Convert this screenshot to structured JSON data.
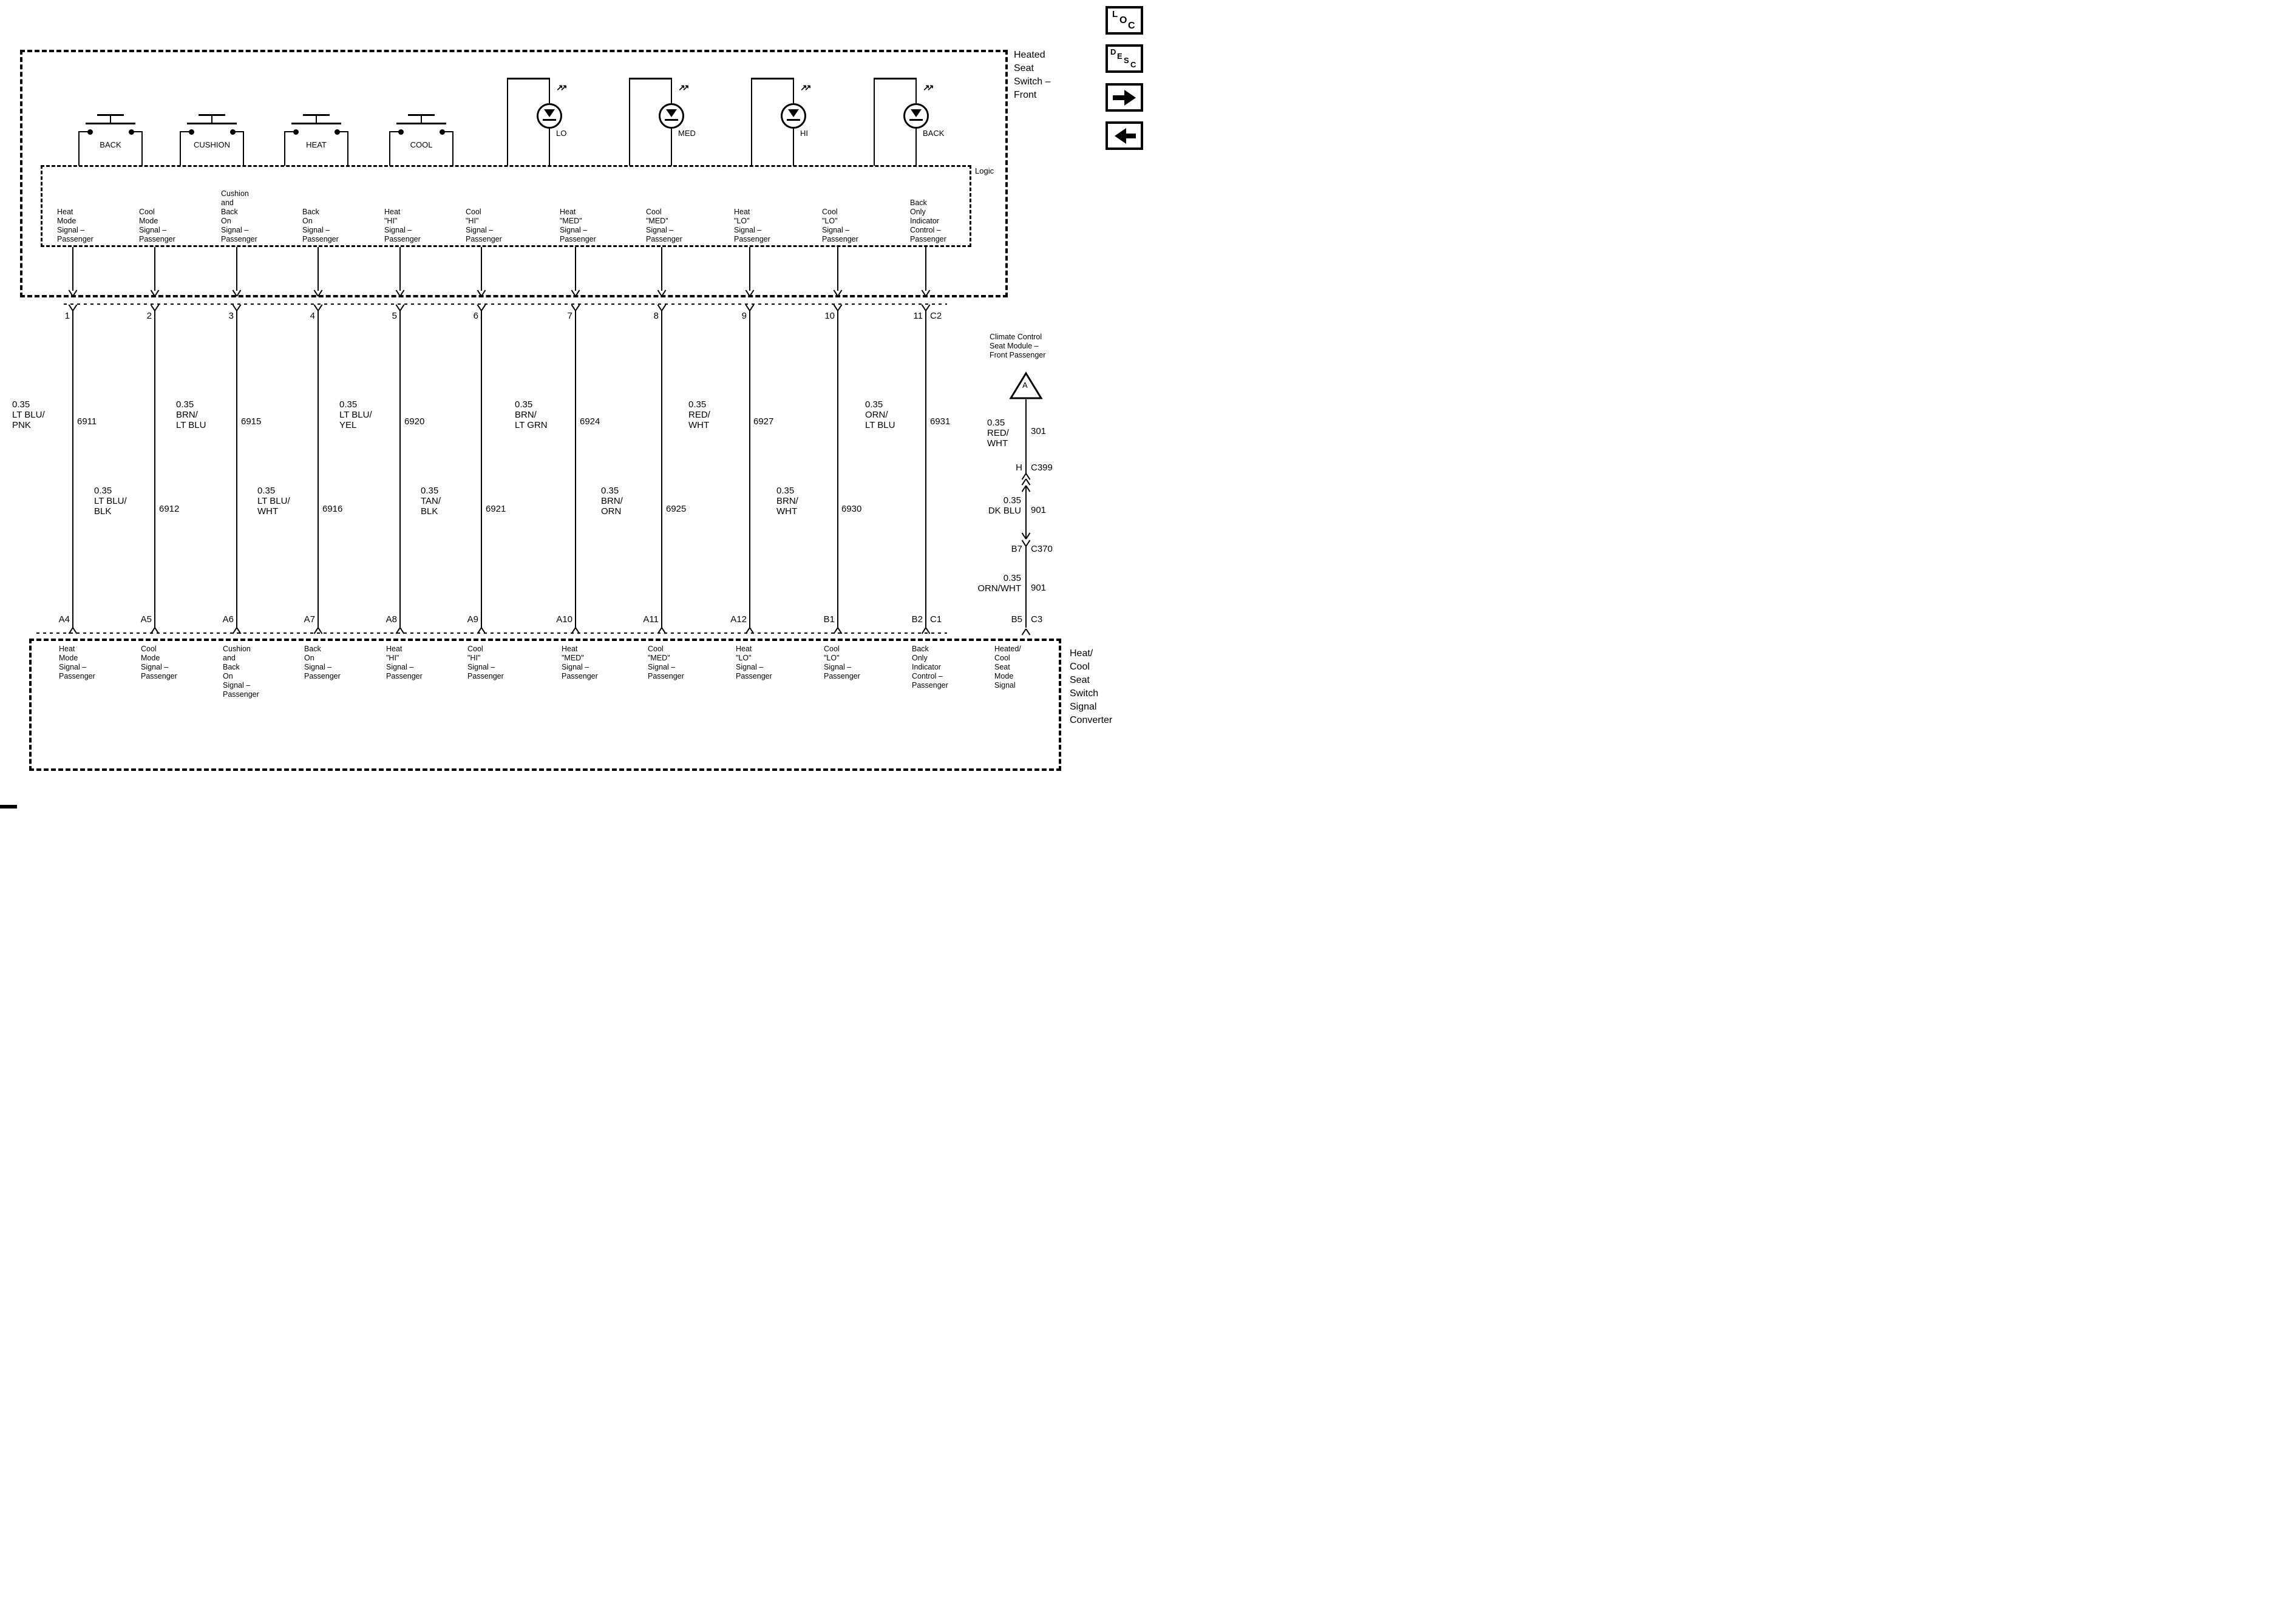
{
  "toolbar": {
    "loc": [
      "L",
      "O",
      "C"
    ],
    "desc": [
      "D",
      "E",
      "S",
      "C"
    ]
  },
  "top_box": {
    "title": "Heated\nSeat\nSwitch –\nFront",
    "logic_label": "Logic",
    "switches": [
      "BACK",
      "CUSHION",
      "HEAT",
      "COOL"
    ],
    "leds": [
      "LO",
      "MED",
      "HI",
      "BACK"
    ],
    "connector": "C2"
  },
  "bottom_box": {
    "title": "Heat/\nCool\nSeat\nSwitch\nSignal\nConverter",
    "connector": "C1",
    "mode_signal": "Heated/\nCool\nSeat\nMode\nSignal"
  },
  "right_branch": {
    "module": "Climate Control\nSeat Module –\nFront Passenger",
    "connector_a": "A",
    "seg1_color": "0.35\nRED/\nWHT",
    "seg1_circuit": "301",
    "c399_pin": "H",
    "c399_connector": "C399",
    "seg2_color": "0.35\nDK BLU",
    "seg2_circuit": "901",
    "c370_pin": "B7",
    "c370_connector": "C370",
    "seg3_color": "0.35\nORN/WHT",
    "seg3_circuit": "901",
    "c3_pin": "B5",
    "c3_connector": "C3"
  },
  "wires": [
    {
      "pin": "1",
      "bottom_pin": "A4",
      "color": "0.35\nLT BLU/\nPNK",
      "circuit": "6911",
      "signal": "Heat\nMode\nSignal –\nPassenger"
    },
    {
      "pin": "2",
      "bottom_pin": "A5",
      "color": "0.35\nLT BLU/\nBLK",
      "circuit": "6912",
      "signal": "Cool\nMode\nSignal –\nPassenger"
    },
    {
      "pin": "3",
      "bottom_pin": "A6",
      "color": "0.35\nBRN/\nLT BLU",
      "circuit": "6915",
      "signal": "Cushion\nand\nBack\nOn\nSignal –\nPassenger"
    },
    {
      "pin": "4",
      "bottom_pin": "A7",
      "color": "0.35\nLT BLU/\nWHT",
      "circuit": "6916",
      "signal": "Back\nOn\nSignal –\nPassenger"
    },
    {
      "pin": "5",
      "bottom_pin": "A8",
      "color": "0.35\nLT BLU/\nYEL",
      "circuit": "6920",
      "signal": "Heat\n\"HI\"\nSignal –\nPassenger"
    },
    {
      "pin": "6",
      "bottom_pin": "A9",
      "color": "0.35\nTAN/\nBLK",
      "circuit": "6921",
      "signal": "Cool\n\"HI\"\nSignal –\nPassenger"
    },
    {
      "pin": "7",
      "bottom_pin": "A10",
      "color": "0.35\nBRN/\nLT GRN",
      "circuit": "6924",
      "signal": "Heat\n\"MED\"\nSignal –\nPassenger"
    },
    {
      "pin": "8",
      "bottom_pin": "A11",
      "color": "0.35\nBRN/\nORN",
      "circuit": "6925",
      "signal": "Cool\n\"MED\"\nSignal –\nPassenger"
    },
    {
      "pin": "9",
      "bottom_pin": "A12",
      "color": "0.35\nRED/\nWHT",
      "circuit": "6927",
      "signal": "Heat\n\"LO\"\nSignal –\nPassenger"
    },
    {
      "pin": "10",
      "bottom_pin": "B1",
      "color": "0.35\nBRN/\nWHT",
      "circuit": "6930",
      "signal": "Cool\n\"LO\"\nSignal –\nPassenger"
    },
    {
      "pin": "11",
      "bottom_pin": "B2",
      "color": "0.35\nORN/\nLT BLU",
      "circuit": "6931",
      "signal": "Back\nOnly\nIndicator\nControl –\nPassenger"
    }
  ]
}
